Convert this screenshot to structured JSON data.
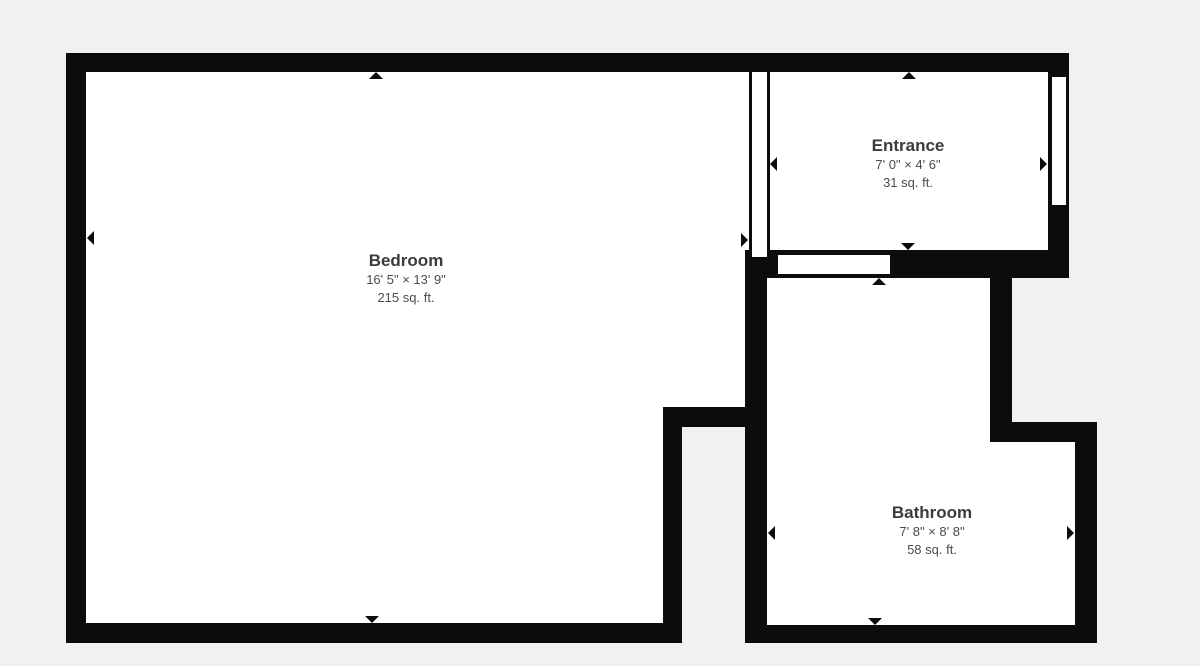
{
  "plan": {
    "colors": {
      "background": "#f2f1ef",
      "wall": "#0c0c0c",
      "room-fill": "#ffffff",
      "title-color": "#3b3b3b",
      "sub-color": "#4c4c4c"
    },
    "rooms": [
      {
        "name": "Bedroom",
        "dimensions": "16' 5\" × 13' 9\"",
        "area": "215 sq. ft."
      },
      {
        "name": "Entrance",
        "dimensions": "7' 0\" × 4' 6\"",
        "area": "31 sq. ft."
      },
      {
        "name": "Bathroom",
        "dimensions": "7' 8\" × 8' 8\"",
        "area": "58 sq. ft."
      }
    ]
  }
}
